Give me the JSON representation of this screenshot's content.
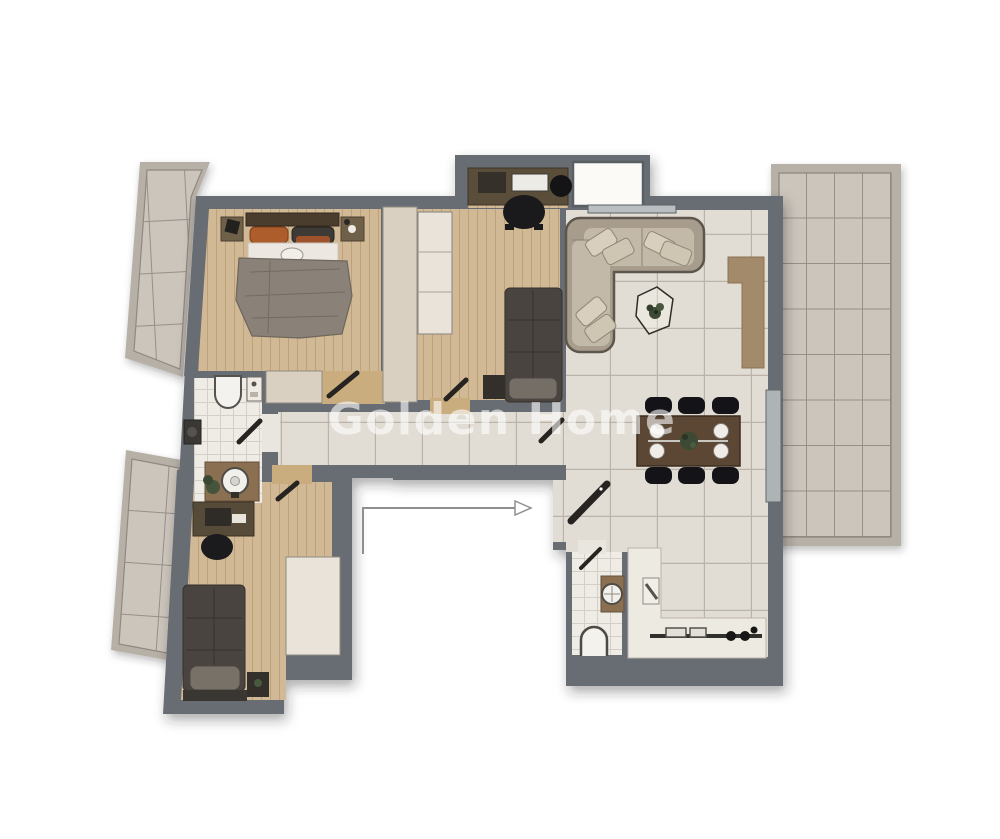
{
  "watermark": {
    "text": "Golden Home"
  },
  "entry": {
    "symbol": "entrance-arrow"
  },
  "colors": {
    "wall": "#686d73",
    "wood": "#d2b996",
    "tile": "#e2ddd4",
    "tileline": "#b9b3a9",
    "bathtile": "#efece6",
    "bathline": "#d4d0c8",
    "balcrim": "#b6b0a7",
    "balctile": "#ccc5bc",
    "balcline": "#96908a",
    "closet": "#d9d0c2",
    "wardrobe": "#e9e3d9",
    "doorwood": "#c9ad7f",
    "sofa": "#a89d8c",
    "cushion": "#c3b9a8",
    "pillow": "#d8cfbf",
    "table": "#5b4733",
    "chair": "#141317",
    "counter": "#edeae2",
    "vanity": "#8a7051",
    "blanketdark": "#49443f",
    "blanketlight": "#8a8178",
    "accent": "#ad5c2c",
    "leaf": "#262320",
    "media": "#a38a6a",
    "watermark_color": "rgba(255,255,255,0.60)"
  }
}
